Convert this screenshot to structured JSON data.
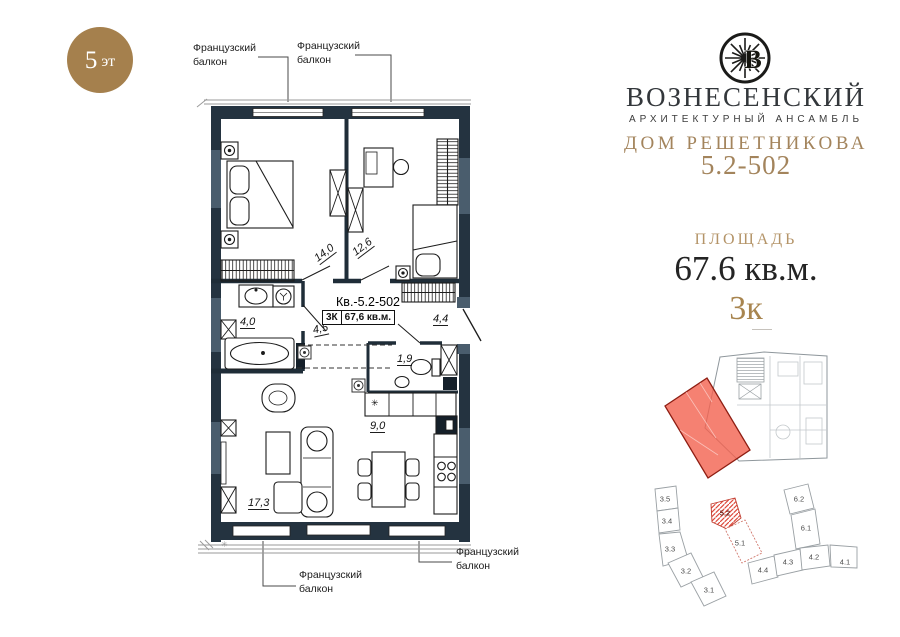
{
  "badge": {
    "number": "5",
    "suffix": "эт"
  },
  "callouts": {
    "french_balcony": "Французский балкон"
  },
  "brand": {
    "monogram": "В",
    "name": "ВОЗНЕСЕНСКИЙ",
    "tagline": "АРХИТЕКТУРНЫЙ АНСАМБЛЬ",
    "house": "ДОМ РЕШЕТНИКОВА",
    "unit_code": "5.2-502"
  },
  "summary": {
    "area_label": "ПЛОЩАДЬ",
    "area_value": "67.6 кв.м.",
    "rooms_value": "3к"
  },
  "plan": {
    "apartment_label": "Кв.-5.2-502",
    "rooms_badge": "3К",
    "area_badge": "67,6 кв.м.",
    "rooms": [
      {
        "id": "bedroom-1",
        "area": "14,0"
      },
      {
        "id": "bedroom-2",
        "area": "12,6"
      },
      {
        "id": "bathroom",
        "area": "4,0"
      },
      {
        "id": "hallway",
        "area": "4,5"
      },
      {
        "id": "entry-hall",
        "area": "4,4"
      },
      {
        "id": "wc",
        "area": "1,9"
      },
      {
        "id": "kitchen",
        "area": "9,0"
      },
      {
        "id": "living-room",
        "area": "17,3"
      }
    ],
    "icons": {
      "fridge": "✳",
      "corner_mark": "✳"
    }
  },
  "minimap": {
    "highlighted_unit": "5.2",
    "buildings": [
      {
        "label": "3.5"
      },
      {
        "label": "3.4"
      },
      {
        "label": "3.3"
      },
      {
        "label": "3.2"
      },
      {
        "label": "3.1"
      },
      {
        "label": "5.2",
        "highlighted": true
      },
      {
        "label": "5.1"
      },
      {
        "label": "6.2"
      },
      {
        "label": "6.1"
      },
      {
        "label": "4.4"
      },
      {
        "label": "4.3"
      },
      {
        "label": "4.2"
      },
      {
        "label": "4.1"
      }
    ]
  },
  "colors": {
    "accent_gold": "#a3845c",
    "badge_brown": "#a5804d",
    "wall_dark": "#243340",
    "wall_slate": "#4a5d6d",
    "highlight_red": "#f2614f"
  }
}
